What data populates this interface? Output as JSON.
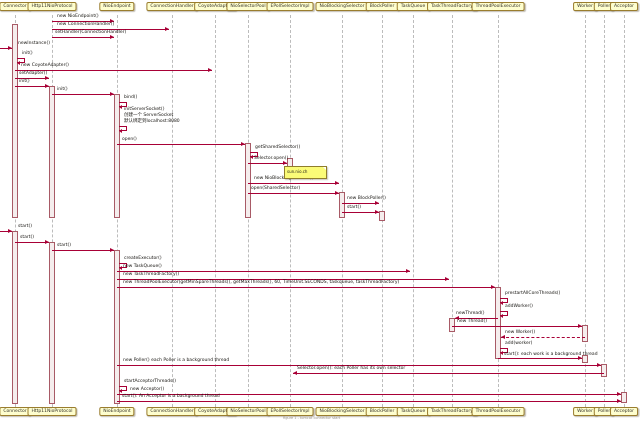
{
  "diagram": {
    "kind": "uml-sequence-diagram",
    "subject": "Tomcat NIO Connector init and start sequence",
    "colors": {
      "background": "#ffffff",
      "arrow": "#a80036",
      "participant_fill": "#fefece",
      "participant_border": "#9a7d2e",
      "activation_fill": "#f5eded",
      "activation_border": "#a85a66",
      "lifeline": "#bcbcbc",
      "note_fill": "#fbfb77",
      "note_border": "#8f7d2c"
    },
    "participants": [
      {
        "id": "connector",
        "label": "Connector",
        "x": 15
      },
      {
        "id": "http11nioprotocol",
        "label": "Http11NioProtocol",
        "x": 52
      },
      {
        "id": "nioendpoint",
        "label": "NioEndpoint",
        "x": 117
      },
      {
        "id": "connectionhandler",
        "label": "ConnectionHandler",
        "x": 172
      },
      {
        "id": "coyoteadapter",
        "label": "CoyoteAdapter",
        "x": 215
      },
      {
        "id": "nioselectorpool",
        "label": "NioSelectorPool",
        "x": 248
      },
      {
        "id": "epollselectorimpl",
        "label": "EPollSelectorImpl",
        "x": 290
      },
      {
        "id": "nioblockingselector",
        "label": "NioBlockingSelector",
        "x": 342
      },
      {
        "id": "blockpoller",
        "label": "BlockPoller",
        "x": 382
      },
      {
        "id": "taskqueue",
        "label": "TaskQueue",
        "x": 413
      },
      {
        "id": "taskthreadfactory",
        "label": "TaskThreadFactory",
        "x": 452
      },
      {
        "id": "threadpoolexecutor",
        "label": "ThreadPoolExecutor",
        "x": 498
      },
      {
        "id": "worker",
        "label": "Worker",
        "x": 585
      },
      {
        "id": "poller",
        "label": "Poller",
        "x": 604
      },
      {
        "id": "acceptor",
        "label": "Acceptor",
        "x": 624
      }
    ],
    "activations": [
      {
        "on": "connector",
        "x": 15,
        "y1": 24,
        "y2": 218
      },
      {
        "on": "http11nioprotocol",
        "x": 52,
        "y1": 86,
        "y2": 218
      },
      {
        "on": "nioendpoint",
        "x": 117,
        "y1": 94,
        "y2": 218
      },
      {
        "on": "nioselectorpool",
        "x": 248,
        "y1": 143,
        "y2": 218
      },
      {
        "on": "epollselectorimpl",
        "x": 290,
        "y1": 158,
        "y2": 172
      },
      {
        "on": "nioblockingselector",
        "x": 342,
        "y1": 192,
        "y2": 218
      },
      {
        "on": "blockpoller",
        "x": 382,
        "y1": 211,
        "y2": 221
      },
      {
        "on": "connector",
        "x": 15,
        "y1": 231,
        "y2": 404
      },
      {
        "on": "http11nioprotocol",
        "x": 52,
        "y1": 242,
        "y2": 404
      },
      {
        "on": "nioendpoint",
        "x": 117,
        "y1": 250,
        "y2": 404
      },
      {
        "on": "threadpoolexecutor",
        "x": 498,
        "y1": 287,
        "y2": 359
      },
      {
        "on": "taskthreadfactory",
        "x": 452,
        "y1": 318,
        "y2": 332
      },
      {
        "on": "worker",
        "x": 585,
        "y1": 325,
        "y2": 342
      },
      {
        "on": "worker",
        "x": 585,
        "y1": 355,
        "y2": 363
      },
      {
        "on": "poller",
        "x": 604,
        "y1": 364,
        "y2": 377
      },
      {
        "on": "acceptor",
        "x": 624,
        "y1": 392,
        "y2": 403
      }
    ],
    "messages": [
      {
        "type": "solid",
        "from": "http11nioprotocol",
        "to": "nioendpoint",
        "label": "new NioEndpoint()",
        "x1": 52,
        "x2": 117,
        "y": 21,
        "lx": 57,
        "ly": 14
      },
      {
        "type": "solid",
        "from": "http11nioprotocol",
        "to": "connectionhandler",
        "label": "new ConnectionHandler()",
        "x1": 52,
        "x2": 172,
        "y": 29,
        "lx": 57,
        "ly": 22
      },
      {
        "type": "solid",
        "from": "http11nioprotocol",
        "to": "nioendpoint",
        "label": "setHandler(ConnectionHandler)",
        "x1": 52,
        "x2": 117,
        "y": 37,
        "lx": 55,
        "ly": 30
      },
      {
        "type": "found",
        "to": "connector",
        "label": "newInstance()",
        "x2": 12,
        "y": 48,
        "lx": 18,
        "ly": 41
      },
      {
        "type": "self",
        "from": "connector",
        "lines": [
          "init()"
        ],
        "x": 15,
        "y": 58
      },
      {
        "type": "solid",
        "from": "connector",
        "to": "coyoteadapter",
        "label": "new CoyoteAdapter()",
        "x1": 15,
        "x2": 215,
        "y": 70,
        "lx": 21,
        "ly": 63
      },
      {
        "type": "solid",
        "from": "connector",
        "to": "http11nioprotocol",
        "label": "setAdapter()",
        "x1": 15,
        "x2": 52,
        "y": 78,
        "lx": 19,
        "ly": 71
      },
      {
        "type": "solid",
        "from": "connector",
        "to": "http11nioprotocol",
        "label": "init()",
        "x1": 15,
        "x2": 52,
        "y": 86,
        "lx": 19,
        "ly": 79
      },
      {
        "type": "solid",
        "from": "http11nioprotocol",
        "to": "nioendpoint",
        "label": "init()",
        "x1": 52,
        "x2": 117,
        "y": 94,
        "lx": 57,
        "ly": 87
      },
      {
        "type": "self",
        "from": "nioendpoint",
        "lines": [
          "bind()"
        ],
        "x": 117,
        "y": 102
      },
      {
        "type": "self",
        "from": "nioendpoint",
        "lines": [
          "initServerSocket()",
          "创建一个 ServerSocket",
          "默认绑定到localhost:8080"
        ],
        "x": 117,
        "y": 126
      },
      {
        "type": "solid",
        "from": "nioendpoint",
        "to": "nioselectorpool",
        "label": "open()",
        "x1": 117,
        "x2": 248,
        "y": 144,
        "lx": 122,
        "ly": 137
      },
      {
        "type": "self",
        "from": "nioselectorpool",
        "lines": [
          "getSharedSelector()"
        ],
        "x": 248,
        "y": 152
      },
      {
        "type": "solid",
        "from": "nioselectorpool",
        "to": "epollselectorimpl",
        "label": "Selector.open()",
        "x1": 248,
        "x2": 290,
        "y": 163,
        "lx": 254,
        "ly": 156
      },
      {
        "type": "solid",
        "from": "nioselectorpool",
        "to": "nioblockingselector",
        "label": "new NioBlockingSelector()",
        "x1": 248,
        "x2": 342,
        "y": 183,
        "lx": 254,
        "ly": 176
      },
      {
        "type": "solid",
        "from": "nioselectorpool",
        "to": "nioblockingselector",
        "label": "open(SharedSelector)",
        "x1": 248,
        "x2": 342,
        "y": 193,
        "lx": 251,
        "ly": 186
      },
      {
        "type": "solid",
        "from": "nioblockingselector",
        "to": "blockpoller",
        "label": "new BlockPoller()",
        "x1": 342,
        "x2": 382,
        "y": 203,
        "lx": 347,
        "ly": 196
      },
      {
        "type": "solid",
        "from": "nioblockingselector",
        "to": "blockpoller",
        "label": "start()",
        "x1": 342,
        "x2": 382,
        "y": 212,
        "lx": 347,
        "ly": 205
      },
      {
        "type": "found",
        "to": "connector",
        "label": "start()",
        "x2": 12,
        "y": 231,
        "lx": 18,
        "ly": 224
      },
      {
        "type": "solid",
        "from": "connector",
        "to": "http11nioprotocol",
        "label": "start()",
        "x1": 15,
        "x2": 52,
        "y": 242,
        "lx": 20,
        "ly": 235
      },
      {
        "type": "solid",
        "from": "http11nioprotocol",
        "to": "nioendpoint",
        "label": "start()",
        "x1": 52,
        "x2": 117,
        "y": 250,
        "lx": 57,
        "ly": 243
      },
      {
        "type": "self",
        "from": "nioendpoint",
        "lines": [
          "createExecutor()"
        ],
        "x": 117,
        "y": 263
      },
      {
        "type": "solid",
        "from": "nioendpoint",
        "to": "taskqueue",
        "label": "new TaskQueue()",
        "x1": 117,
        "x2": 413,
        "y": 271,
        "lx": 123,
        "ly": 264
      },
      {
        "type": "solid",
        "from": "nioendpoint",
        "to": "taskthreadfactory",
        "label": "new TaskThreadFactory()",
        "x1": 117,
        "x2": 452,
        "y": 279,
        "lx": 123,
        "ly": 272
      },
      {
        "type": "solid",
        "from": "nioendpoint",
        "to": "threadpoolexecutor",
        "label": "new ThreadPoolExecutor(getMinSpareThreads(), getMaxThreads(), 60, TimeUnit.SECONDS, taskqueue, taskThreadFactory)",
        "x1": 117,
        "x2": 498,
        "y": 287,
        "lx": 123,
        "ly": 280
      },
      {
        "type": "self",
        "from": "threadpoolexecutor",
        "lines": [
          "prestartAllCoreThreads()"
        ],
        "x": 498,
        "y": 298
      },
      {
        "type": "self",
        "from": "threadpoolexecutor",
        "lines": [
          "addWorker()"
        ],
        "x": 498,
        "y": 311
      },
      {
        "type": "solid",
        "from": "threadpoolexecutor",
        "to": "taskthreadfactory",
        "label": "newThread()",
        "x1": 498,
        "x2": 452,
        "y": 318,
        "lx": 456,
        "ly": 311
      },
      {
        "type": "solid",
        "from": "taskthreadfactory",
        "to": "worker",
        "label": "new Thread()",
        "x1": 452,
        "x2": 585,
        "y": 326,
        "lx": 457,
        "ly": 319
      },
      {
        "type": "dashed",
        "from": "worker",
        "to": "threadpoolexecutor",
        "label": "new Worker()",
        "x1": 585,
        "x2": 498,
        "y": 337,
        "lx": 505,
        "ly": 330
      },
      {
        "type": "self",
        "from": "threadpoolexecutor",
        "lines": [
          "add(worker)"
        ],
        "x": 498,
        "y": 348
      },
      {
        "type": "solid",
        "from": "threadpoolexecutor",
        "to": "worker",
        "label": "start(): each work is a background thread",
        "x1": 498,
        "x2": 585,
        "y": 358,
        "lx": 504,
        "ly": 352
      },
      {
        "type": "solid",
        "from": "nioendpoint",
        "to": "poller",
        "label": "new Poller() each Poller is a background thread",
        "x1": 117,
        "x2": 604,
        "y": 365,
        "lx": 123,
        "ly": 358
      },
      {
        "type": "solid",
        "from": "poller",
        "to": "epollselectorimpl",
        "label": "Selector.open(): each Poller has its own selector",
        "x1": 604,
        "x2": 290,
        "y": 373,
        "lx": 297,
        "ly": 366
      },
      {
        "type": "self",
        "from": "nioendpoint",
        "lines": [
          "startAcceptorThreads()"
        ],
        "x": 117,
        "y": 386
      },
      {
        "type": "solid",
        "from": "nioendpoint",
        "to": "acceptor",
        "label": "new Acceptor()",
        "x1": 117,
        "x2": 624,
        "y": 394,
        "lx": 130,
        "ly": 387
      },
      {
        "type": "solid",
        "from": "nioendpoint",
        "to": "acceptor",
        "label": "start(): An Acceptor is a background thread",
        "x1": 117,
        "x2": 624,
        "y": 401,
        "lx": 122,
        "ly": 394
      }
    ],
    "note": {
      "text": "sun.nio.ch",
      "attached_to": "epollselectorimpl",
      "x": 284,
      "y": 166,
      "w": 42,
      "h": 11
    },
    "caption": "figure 1 - tomcat connector start"
  }
}
